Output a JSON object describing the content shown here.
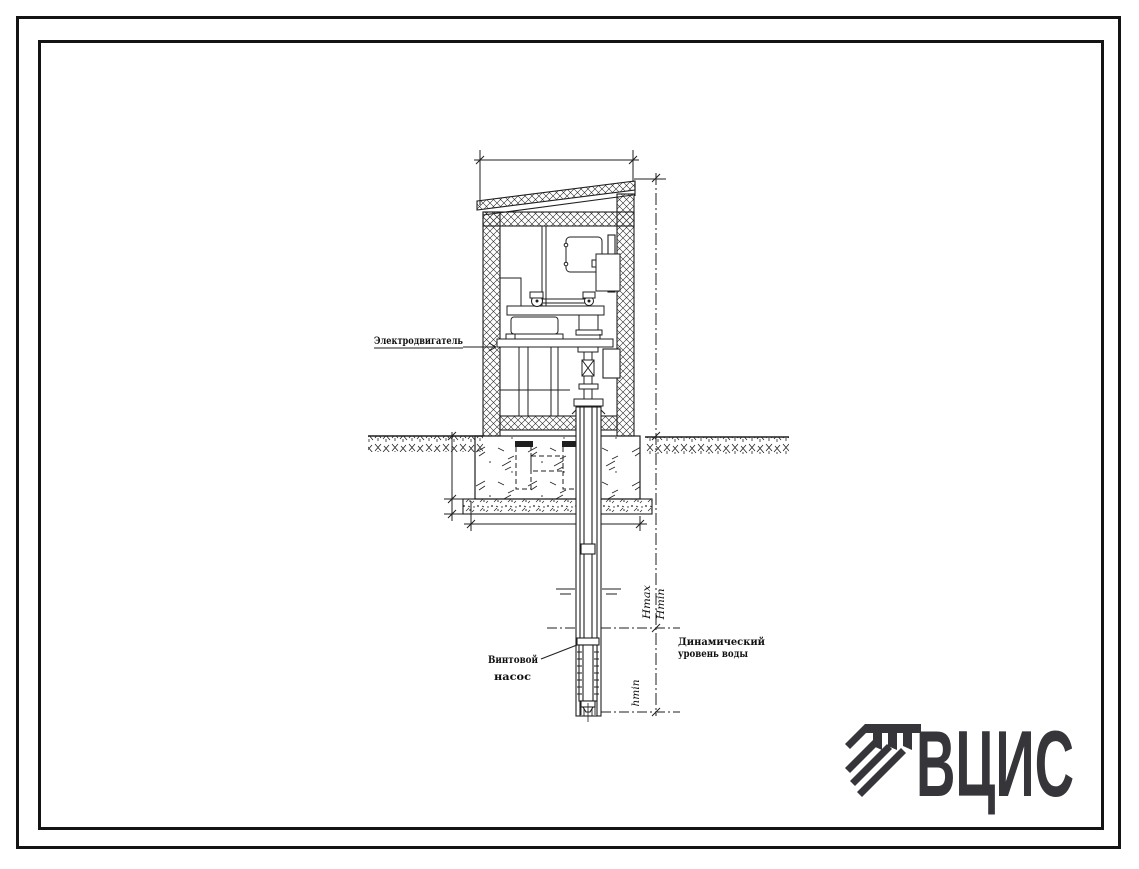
{
  "drawing": {
    "callouts": {
      "motor": "Электродвигатель",
      "pump_line1": "Винтовой",
      "pump_line2": "насос",
      "dynamic_level_line1": "Динамический",
      "dynamic_level_line2": "уровень воды"
    },
    "dimensions": {
      "h_max": "Hmax",
      "h_min": "Hmin",
      "h_lower": "hmin"
    },
    "colors": {
      "ink": "#1f1f1f",
      "paper": "#ffffff"
    }
  },
  "logo": {
    "text": "ВЦИС",
    "icon": "vcis-column-emblem-icon",
    "color": "#35353a"
  }
}
